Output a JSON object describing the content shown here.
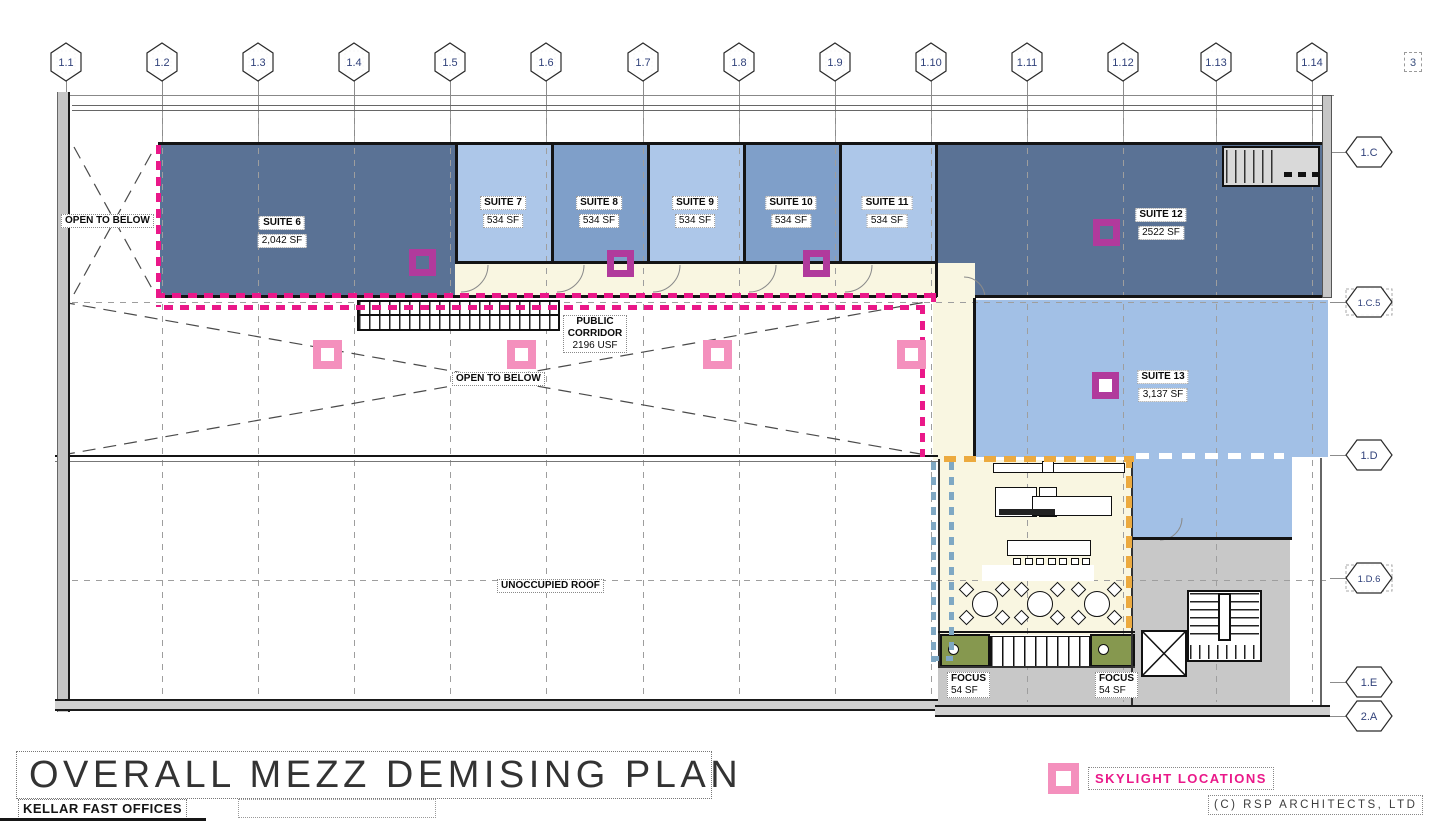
{
  "sheet": {
    "title": "OVERALL MEZZ DEMISING PLAN",
    "project": "KELLAR FAST OFFICES",
    "copyright": "(C) RSP ARCHITECTS, LTD",
    "sheet_number": "3"
  },
  "legend": {
    "skylight_label": "SKYLIGHT LOCATIONS"
  },
  "grid": {
    "columns": [
      {
        "label": "1.1"
      },
      {
        "label": "1.2"
      },
      {
        "label": "1.3"
      },
      {
        "label": "1.4"
      },
      {
        "label": "1.5"
      },
      {
        "label": "1.6"
      },
      {
        "label": "1.7"
      },
      {
        "label": "1.8"
      },
      {
        "label": "1.9"
      },
      {
        "label": "1.10"
      },
      {
        "label": "1.11"
      },
      {
        "label": "1.12"
      },
      {
        "label": "1.13"
      },
      {
        "label": "1.14"
      }
    ],
    "rows": [
      {
        "label": "1.C",
        "dashed": false
      },
      {
        "label": "1.C.5",
        "dashed": true
      },
      {
        "label": "1.D",
        "dashed": false
      },
      {
        "label": "1.D.6",
        "dashed": true
      },
      {
        "label": "1.E",
        "dashed": false
      },
      {
        "label": "2.A",
        "dashed": false
      }
    ]
  },
  "suites": [
    {
      "id": "suite-6",
      "name": "SUITE 6",
      "area": "2,042 SF",
      "shade": "dark"
    },
    {
      "id": "suite-7",
      "name": "SUITE 7",
      "area": "534 SF",
      "shade": "light"
    },
    {
      "id": "suite-8",
      "name": "SUITE 8",
      "area": "534 SF",
      "shade": "medium"
    },
    {
      "id": "suite-9",
      "name": "SUITE 9",
      "area": "534 SF",
      "shade": "light"
    },
    {
      "id": "suite-10",
      "name": "SUITE 10",
      "area": "534 SF",
      "shade": "medium"
    },
    {
      "id": "suite-11",
      "name": "SUITE 11",
      "area": "534 SF",
      "shade": "light"
    },
    {
      "id": "suite-12",
      "name": "SUITE 12",
      "area": "2522 SF",
      "shade": "dark"
    },
    {
      "id": "suite-13",
      "name": "SUITE 13",
      "area": "3,137 SF",
      "shade": "suite13"
    }
  ],
  "rooms": {
    "public_corridor": {
      "name": "PUBLIC CORRIDOR",
      "area": "2196 USF"
    },
    "focus_rooms": [
      {
        "name": "FOCUS",
        "area": "54 SF"
      },
      {
        "name": "FOCUS",
        "area": "54 SF"
      }
    ]
  },
  "annotations": {
    "open_to_below_left": "OPEN TO BELOW",
    "open_to_below_center": "OPEN TO BELOW",
    "unoccupied_roof": "UNOCCUPIED ROOF"
  },
  "colors": {
    "suite_dark": "#5a7295",
    "suite_light": "#adc7e9",
    "suite_medium": "#7f9fc9",
    "suite_13": "#a2c0e6",
    "corridor_cream": "#f9f6e1",
    "focus_green": "#86984f",
    "common_gray": "#c8c8c8",
    "skylight_magenta": "#b13a9c",
    "skylight_pink": "#f490bd",
    "demising_magenta": "#ea1889",
    "demising_orange": "#ecaa3f",
    "demising_blue": "#7fa8c4"
  }
}
